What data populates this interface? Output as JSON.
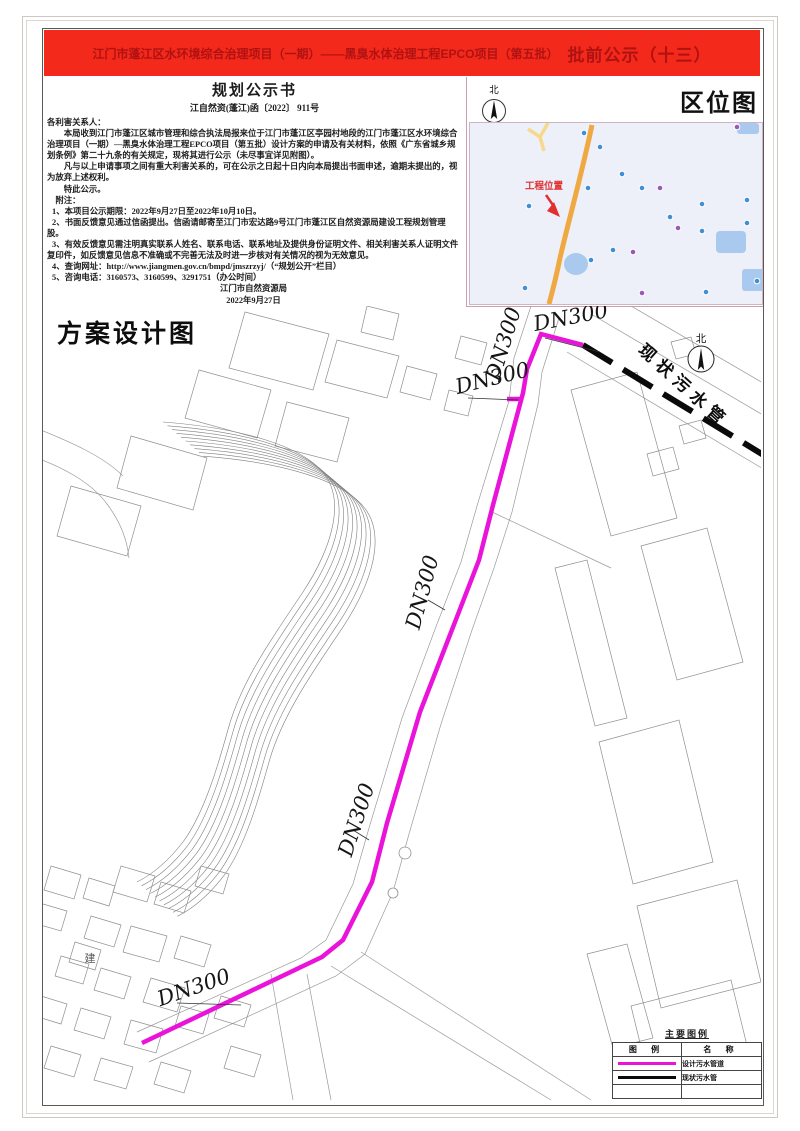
{
  "banner": {
    "title_main": "江门市蓬江区水环境综合治理项目（一期）——黑臭水体治理工程EPCO项目（第五批）",
    "title_suffix": "批前公示（十三）"
  },
  "notice": {
    "heading": "规划公示书",
    "doc_number": "江自然资(蓬江)函〔2022〕 911号",
    "salutation": "各利害关系人：",
    "para1_pre": "本局收到江门市蓬江区城市管理和综合执法局报来位于江门市蓬江区亭园村地段的",
    "para1_bold": "江门市蓬江区水环境综合治理项目（一期）—黑臭水体治理工程EPCO项目（第五批）",
    "para1_post": "设计方案的申请及有关材料，依照《广东省城乡规划条例》第二十九条的有关规定，现将其进行公示（未尽事宜详见附图）。",
    "para2": "凡与以上申请事项之间有重大利害关系的，可在公示之日起十日内向本局提出书面申述，逾期未提出的，视为放弃上述权利。",
    "para3": "特此公示。",
    "notes_label": "附注：",
    "note1": "1、本项目公示期限：2022年9月27日至2022年10月10日。",
    "note2": "2、书面反馈意见通过信函提出。信函请邮寄至江门市宏达路9号江门市蓬江区自然资源局建设工程规划管理股。",
    "note3": "3、有效反馈意见需注明真实联系人姓名、联系电话、联系地址及提供身份证明文件、相关利害关系人证明文件复印件，如反馈意见信息不准确或不完善无法及时进一步核对有关情况的视为无效意见。",
    "note4": "4、查询网址：http://www.jiangmen.gov.cn/bmpd/jmszrzyj/（“规划公开”栏目）",
    "note5": "5、咨询电话：3160573、3160599、3291751（办公时间）",
    "issuer": "江门市自然资源局",
    "date": "2022年9月27日"
  },
  "location_map": {
    "title": "区位图",
    "north_label": "北",
    "marker_label": "工程位置"
  },
  "plan": {
    "title": "方案设计图",
    "north_label": "北",
    "pipe_label": "DN300",
    "existing_pipe_label": "现状污水管",
    "building_label": "建"
  },
  "legend": {
    "title": "主要图例",
    "col_symbol": "图  例",
    "col_name": "名  称",
    "rows": [
      {
        "name": "设计污水管道"
      },
      {
        "name": "现状污水管"
      }
    ]
  },
  "colors": {
    "banner_bg": "#f2291b",
    "banner_text": "#b01212",
    "design_pipe": "#e913da",
    "existing_pipe": "#0a0a0a",
    "map_road": "#f0a843",
    "map_water": "#a9c9ee",
    "marker_red": "#e03030"
  }
}
